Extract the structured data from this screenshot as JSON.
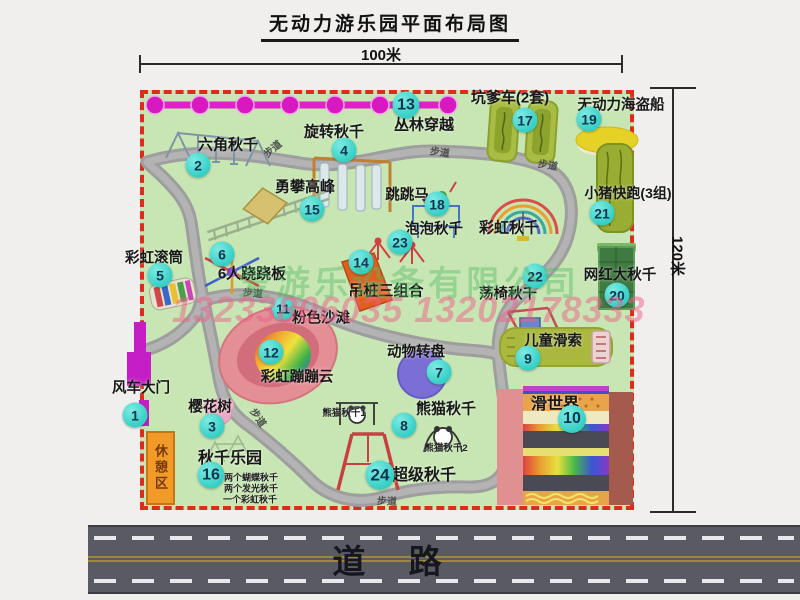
{
  "title": "无动力游乐园平面布局图",
  "dimensions": {
    "top": "100米",
    "right": "120米"
  },
  "road": {
    "label": "道 路"
  },
  "watermark": {
    "company": "爱游乐设备有限公司",
    "phone": "13233806035 13202178333"
  },
  "rest_area": {
    "label": "休憩区"
  },
  "colors": {
    "map_bg": "#c8e6b4",
    "border_red": "#df2b1a",
    "badge_teal": "#35cfc6",
    "road_gray": "#5a5a64",
    "path_gray": "#9e9e9e",
    "jungle_magenta": "#e020c8"
  },
  "map": {
    "attractions": [
      {
        "num": "1",
        "name": "风车大门",
        "badge": [
          135,
          415
        ],
        "label": [
          141,
          387
        ],
        "size": 14.5
      },
      {
        "num": "2",
        "name": "六角秋千",
        "badge": [
          198,
          165
        ],
        "label": [
          228,
          144
        ],
        "size": 15
      },
      {
        "num": "3",
        "name": "樱花树",
        "badge": [
          212,
          426
        ],
        "label": [
          210,
          406
        ],
        "size": 14.5
      },
      {
        "num": "4",
        "name": "旋转秋千",
        "badge": [
          344,
          150
        ],
        "label": [
          334,
          131
        ],
        "size": 15
      },
      {
        "num": "5",
        "name": "彩虹滚筒",
        "badge": [
          160,
          275
        ],
        "label": [
          154,
          257
        ],
        "size": 14.5
      },
      {
        "num": "6",
        "name": "6人跷跷板",
        "badge": [
          222,
          254
        ],
        "label": [
          252,
          273
        ],
        "size": 15
      },
      {
        "num": "7",
        "name": "动物转盘",
        "badge": [
          439,
          372
        ],
        "label": [
          416,
          351
        ],
        "size": 14.5
      },
      {
        "num": "8",
        "name": "熊猫秋千",
        "badge": [
          404,
          425
        ],
        "label": [
          446,
          408
        ],
        "size": 15,
        "sublabels": [
          {
            "text": "熊猫秋千1",
            "pos": [
              344,
              412
            ],
            "size": 9.5
          },
          {
            "text": "熊猫秋千2",
            "pos": [
              446,
              447
            ],
            "size": 9.5
          }
        ]
      },
      {
        "num": "9",
        "name": "儿童滑索",
        "badge": [
          528,
          358
        ],
        "label": [
          553,
          340
        ],
        "size": 14.5
      },
      {
        "num": "10",
        "name": "滑世界",
        "badge": [
          572,
          419
        ],
        "label": [
          555,
          402
        ],
        "size": 16,
        "badge_size": 28
      },
      {
        "num": "11",
        "name": "粉色沙滩",
        "badge": [
          283,
          309
        ],
        "label": [
          321,
          317
        ],
        "size": 14.5,
        "badge_size": 23
      },
      {
        "num": "12",
        "name": "彩虹蹦蹦云",
        "badge": [
          271,
          352
        ],
        "label": [
          297,
          376
        ],
        "size": 14.5
      },
      {
        "num": "13",
        "name": "丛林穿越",
        "badge": [
          406,
          105
        ],
        "label": [
          424,
          124
        ],
        "size": 15,
        "badge_size": 27
      },
      {
        "num": "14",
        "name": "吊桩三组合",
        "badge": [
          361,
          262
        ],
        "label": [
          386,
          290
        ],
        "size": 15
      },
      {
        "num": "15",
        "name": "勇攀高峰",
        "badge": [
          312,
          209
        ],
        "label": [
          305,
          186
        ],
        "size": 15
      },
      {
        "num": "16",
        "name": "秋千乐园",
        "badge": [
          211,
          475
        ],
        "label": [
          230,
          456
        ],
        "size": 16,
        "badge_size": 27,
        "sublabels": [
          {
            "text": "两个蝴蝶秋千",
            "pos": [
              251,
              477
            ],
            "size": 9
          },
          {
            "text": "两个发光秋千",
            "pos": [
              251,
              488
            ],
            "size": 9
          },
          {
            "text": "一个彩虹秋千",
            "pos": [
              250,
              499
            ],
            "size": 9
          }
        ]
      },
      {
        "num": "17",
        "name": "坑爹车(2套)",
        "badge": [
          525,
          120
        ],
        "label": [
          510,
          97
        ],
        "size": 15
      },
      {
        "num": "18",
        "name": "跳跳马",
        "badge": [
          437,
          204
        ],
        "label": [
          407,
          194
        ],
        "size": 14.5
      },
      {
        "num": "19",
        "name": "无动力海盗船",
        "badge": [
          589,
          119
        ],
        "label": [
          621,
          104
        ],
        "size": 14.5
      },
      {
        "num": "20",
        "name": "网红大秋千",
        "badge": [
          617,
          295
        ],
        "label": [
          620,
          274
        ],
        "size": 14.5
      },
      {
        "num": "21",
        "name": "小猪快跑(3组)",
        "badge": [
          602,
          213
        ],
        "label": [
          628,
          193
        ],
        "size": 14
      },
      {
        "num": "22",
        "name": "荡椅秋千",
        "badge": [
          535,
          276
        ],
        "label": [
          508,
          293
        ],
        "size": 14.5
      },
      {
        "num": "23",
        "name": "泡泡秋千",
        "badge": [
          400,
          242
        ],
        "label": [
          434,
          228
        ],
        "size": 14.5
      },
      {
        "num": "24",
        "name": "超级秋千",
        "badge": [
          380,
          475
        ],
        "label": [
          424,
          473
        ],
        "size": 16,
        "badge_size": 29
      }
    ],
    "feature_labels": [
      {
        "text": "彩虹秋千",
        "pos": [
          509,
          227
        ],
        "size": 15
      }
    ],
    "path_labels": [
      {
        "text": "步道",
        "pos": [
          272,
          148
        ],
        "rot": -40
      },
      {
        "text": "步道",
        "pos": [
          440,
          151
        ],
        "rot": 8
      },
      {
        "text": "步道",
        "pos": [
          548,
          164
        ],
        "rot": 10
      },
      {
        "text": "步道",
        "pos": [
          253,
          292
        ],
        "rot": 5
      },
      {
        "text": "步道",
        "pos": [
          259,
          417
        ],
        "rot": 55
      },
      {
        "text": "步道",
        "pos": [
          387,
          500
        ],
        "rot": 3
      }
    ]
  }
}
